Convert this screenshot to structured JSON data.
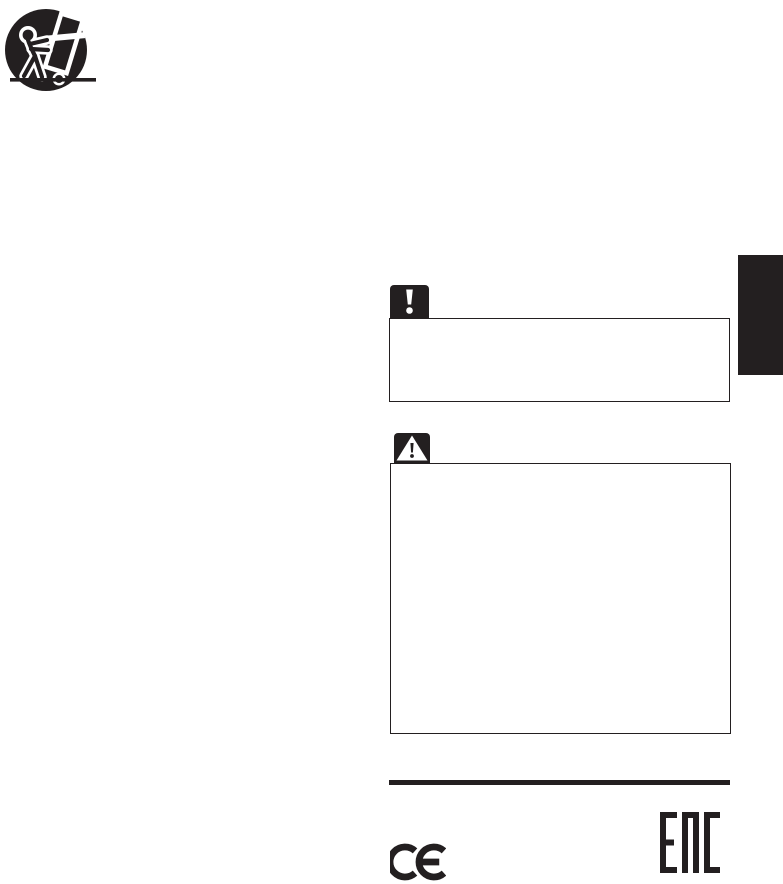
{
  "page": {
    "kind": "scanned-manual-safety-page",
    "background_color": "#ffffff",
    "ink_color": "#231f20"
  },
  "icons": {
    "cart_warning_label": "cart-tip-warning-icon",
    "caution_icon_label": "exclamation-icon",
    "warning_icon_label": "warning-triangle-icon"
  },
  "side_tab": {
    "label": ""
  },
  "notes": {
    "caution": {
      "body": ""
    },
    "warning": {
      "body": ""
    }
  },
  "footer": {
    "ce_mark_label": "CE",
    "eac_mark_label": "EAC"
  }
}
